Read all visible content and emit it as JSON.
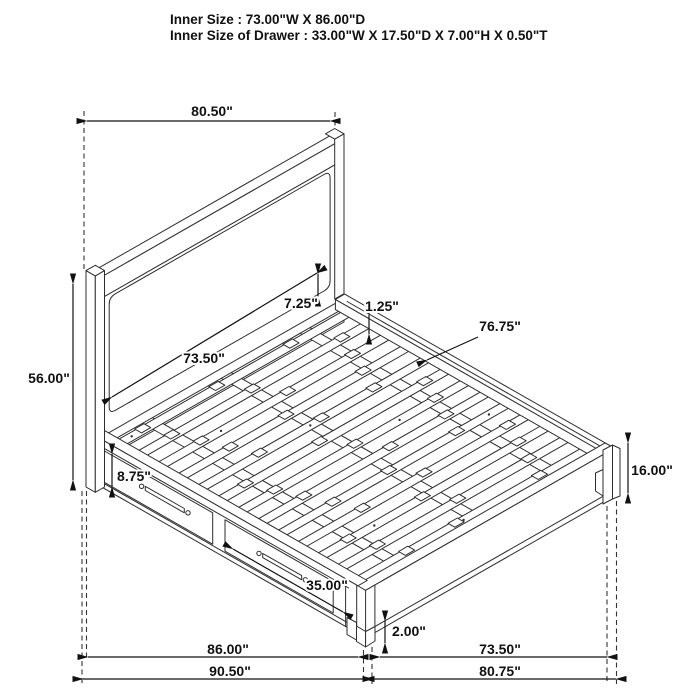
{
  "header": {
    "line1": "Inner Size : 73.00\"W X 86.00\"D",
    "line2": "Inner Size of Drawer : 33.00\"W X 17.50\"D X 7.00\"H X 0.50\"T"
  },
  "diagram": {
    "type": "isometric_dimension_drawing",
    "subject": "storage platform bed with headboard, slat deck and two side drawers",
    "units": "inches",
    "dimensions": [
      {
        "id": "overall-width",
        "label": "80.50\""
      },
      {
        "id": "headboard-height",
        "label": "56.00\""
      },
      {
        "id": "headboard-post-width",
        "label": "7.25\""
      },
      {
        "id": "slat-inset",
        "label": "1.25\""
      },
      {
        "id": "slat-length",
        "label": "76.75\""
      },
      {
        "id": "headboard-inner-width",
        "label": "73.50\""
      },
      {
        "id": "drawer-front-height",
        "label": "8.75\""
      },
      {
        "id": "drawer-front-width",
        "label": "35.00\""
      },
      {
        "id": "footboard-height",
        "label": "16.00\""
      },
      {
        "id": "floor-clearance",
        "label": "2.00\""
      },
      {
        "id": "side-rail-length",
        "label": "86.00\""
      },
      {
        "id": "overall-depth",
        "label": "90.50\""
      },
      {
        "id": "footboard-inner-width",
        "label": "73.50\""
      },
      {
        "id": "footboard-outer-width",
        "label": "80.75\""
      }
    ]
  }
}
